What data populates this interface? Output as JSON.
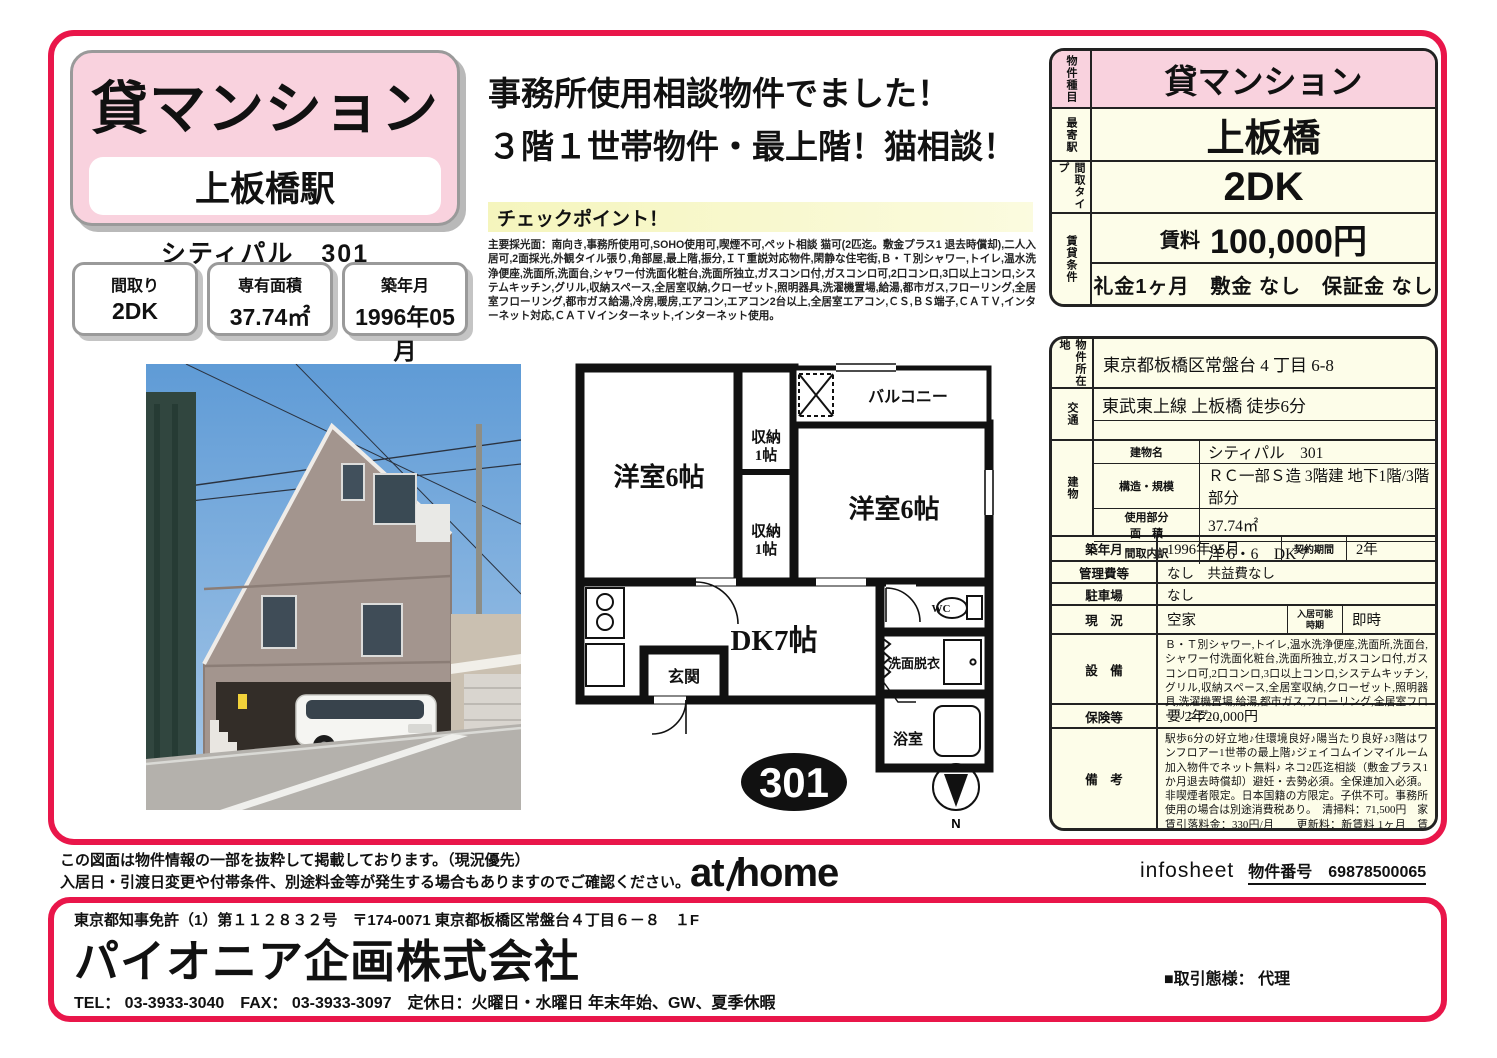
{
  "title_box": {
    "category": "貸マンション",
    "station": "上板橋駅"
  },
  "building_line": "シティパル　301",
  "stats": [
    {
      "label": "間取り",
      "value": "2DK"
    },
    {
      "label": "専有面積",
      "value": "37.74㎡"
    },
    {
      "label": "築年月",
      "value": "1996年05月"
    }
  ],
  "headline": {
    "line1": "事務所使用相談物件でました！",
    "line2": "３階１世帯物件・最上階！猫相談！"
  },
  "checkpoint": {
    "title": "チェックポイント！",
    "body": "主要採光面：南向き,事務所使用可,SOHO使用可,喫煙不可,ペット相談 猫可(2匹迄。敷金プラス1 退去時償却),二人入居可,2面採光,外観タイル張り,角部屋,最上階,振分,ＩＴ重説対応物件,閑静な住宅街,Ｂ・Ｔ別シャワー,トイレ,温水洗浄便座,洗面所,洗面台,シャワー付洗面化粧台,洗面所独立,ガスコンロ付,ガスコンロ可,2口コンロ,3口以上コンロ,システムキッチン,グリル,収納スペース,全居室収納,クローゼット,照明器具,洗濯機置場,給湯,都市ガス,フローリング,全居室フローリング,都市ガス給湯,冷房,暖房,エアコン,エアコン2台以上,全居室エアコン,ＣＳ,ＢＳ端子,ＣＡＴＶ,インターネット対応,ＣＡＴＶインターネット,インターネット使用。"
  },
  "summary": {
    "r1_label": "物件種目",
    "r1_value": "貸マンション",
    "r2_label": "最寄駅",
    "r2_value": "上板橋",
    "r3_label": "間取タイプ",
    "r3_value": "2DK",
    "r4_label": "賃貸条件",
    "rent_word": "賃料",
    "rent_value": "100,000円",
    "terms": "礼金1ヶ月　敷金 なし　保証金 なし"
  },
  "details": {
    "location_label": "物件所在地",
    "location": "東京都板橋区常盤台 4 丁目 6-8",
    "access_label": "交通",
    "access": "東武東上線 上板橋 徒歩6分",
    "building_label": "建物",
    "building_rows": [
      {
        "label": "建物名",
        "value": "シティパル　301"
      },
      {
        "label": "構造・規模",
        "value": "ＲＣ一部Ｓ造 3階建 地下1階/3階部分"
      },
      {
        "label": "使用部分\n面　積",
        "value": "37.74㎡"
      },
      {
        "label": "間取内訳",
        "value": "洋 6・6　DK 7"
      }
    ],
    "built_label": "築年月",
    "built": "1996年05月",
    "contract_label": "契約期間",
    "contract": "2年",
    "mgmt_label": "管理費等",
    "mgmt": "なし　共益費なし",
    "parking_label": "駐車場",
    "parking": "なし",
    "status_label": "現　況",
    "status": "空家",
    "movein_label": "入居可能\n時期",
    "movein": "即時",
    "equip_label": "設　備",
    "equipment": "Ｂ・Ｔ別シャワー,トイレ,温水洗浄便座,洗面所,洗面台,シャワー付洗面化粧台,洗面所独立,ガスコンロ付,ガスコンロ可,2口コンロ,3口以上コンロ,システムキッチン,グリル,収納スペース,全居室収納,クローゼット,照明器具,洗濯機置場,給湯,都市ガス,フローリング,全居室フローリング…",
    "insurance_label": "保険等",
    "insurance": "要 2年20,000円",
    "remarks_label": "備　考",
    "remarks": "駅歩6分の好立地♪住環境良好♪陽当たり良好♪3階はワンフロアー1世帯の最上階♪ジェイコムインマイルーム加入物件でネット無料♪ ネコ2匹迄相談（敷金プラス1か月退去時償却）避妊・去勢必須。全保連加入必須。非喫煙者限定。日本国籍の方限定。子供不可。事務所使用の場合は別途消費税あり。　清掃料：71,500円　家賃引落料金：330円/月　　更新料：新賃料 1ヶ月　賃貸保証：加入要 全保連・保証料５０％・１年毎１３０００円。事務所使用の場合１００％・１年毎１０％　鍵交換代等：有　22,000円～　利用駅1：都営三田線 志村三丁目 徒歩23分 利用駅2：東京メトロ有楽町線 氷川台 徒歩33分"
  },
  "floorplan": {
    "room_left": "洋室6帖",
    "room_right": "洋室6帖",
    "closet": "収納",
    "closet_jo": "1帖",
    "balcony": "バルコニー",
    "dk": "DK7帖",
    "entrance": "玄関",
    "wc": "WC",
    "washroom": "洗面脱衣",
    "bath": "浴室",
    "unit": "301",
    "north": "N"
  },
  "footer": {
    "disclaimer1": "この図面は物件情報の一部を抜粋して掲載しております。（現況優先）",
    "disclaimer2": "入居日・引渡日変更や付帯条件、別途料金等が発生する場合もありますのでご確認ください。",
    "logo_at": "at",
    "logo_home": "home",
    "infosheet": "infosheet",
    "property_no_label": "物件番号",
    "property_no": "69878500065"
  },
  "company": {
    "license": "東京都知事免許（1）第１１２８３２号　〒174-0071 東京都板橋区常盤台４丁目６－８　１F",
    "name": "パイオニア企画株式会社",
    "contact": "TEL： 03-3933-3040　FAX： 03-3933-3097　定休日：火曜日・水曜日 年末年始、GW、夏季休暇",
    "dealing": "■取引態様： 代理"
  }
}
